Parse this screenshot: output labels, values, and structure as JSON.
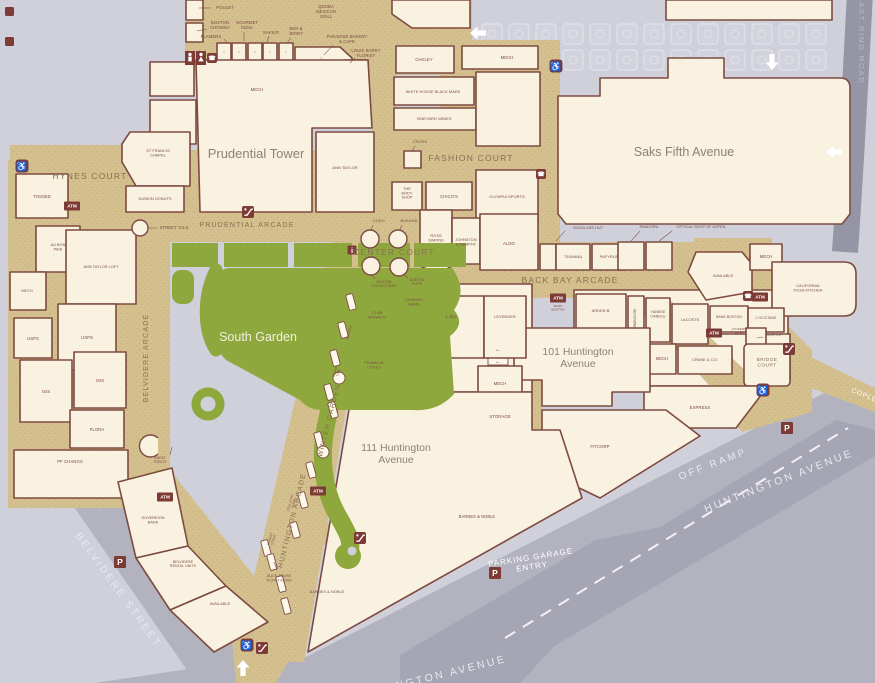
{
  "title": "Prudential Center mall directory map",
  "colors": {
    "walkway": "#d4c08f",
    "speckle": "#c6ae74",
    "block": "#f9f2e1",
    "outline": "#7e4a40",
    "garden": "#8ea83e",
    "street": "#b3b3c0",
    "ramp": "#a5a5b3",
    "badge": "#7e3b36",
    "label": "#7b4a42"
  },
  "labels": [
    {
      "id": "poulet",
      "t": "POULET",
      "x": 225,
      "y": 9,
      "ld": [
        211,
        8,
        199,
        8
      ]
    },
    {
      "id": "boston-chowda",
      "t": "BOSTON|CHOWDA",
      "x": 220,
      "y": 24,
      "ld": [
        207,
        29,
        197,
        31
      ]
    },
    {
      "id": "flamers",
      "t": "FLAMERS",
      "x": 211,
      "y": 38,
      "ld": [
        224,
        39,
        228,
        44
      ]
    },
    {
      "id": "gourmet-india",
      "t": "GOURMET|INDIA",
      "x": 247,
      "y": 24,
      "ld": [
        244,
        32,
        244,
        41
      ]
    },
    {
      "id": "sakkio",
      "t": "SAKKIO",
      "x": 271,
      "y": 34,
      "ld": [
        269,
        36,
        267,
        42
      ]
    },
    {
      "id": "ben-jerry",
      "t": "BEN &|JERRY",
      "x": 296,
      "y": 30,
      "ld": [
        291,
        38,
        287,
        43
      ]
    },
    {
      "id": "qdoba",
      "t": "QDOBA|MEXICAN|GRILL",
      "x": 326,
      "y": 8
    },
    {
      "id": "paradise-bakery",
      "t": "PARADISE BAKERY|& CAFE",
      "x": 347,
      "y": 38,
      "ld": [
        333,
        45,
        324,
        55
      ]
    },
    {
      "id": "louie-barry",
      "t": "LOUIE BARRY|FLORIST",
      "x": 366,
      "y": 52,
      "ld": [
        355,
        58,
        350,
        63
      ]
    },
    {
      "id": "mech-top",
      "t": "MECH",
      "x": 257,
      "y": 91
    },
    {
      "id": "oakley",
      "t": "OAKLEY",
      "x": 424,
      "y": 61
    },
    {
      "id": "white-house-black-market",
      "t": "WHITE HOUSE BLACK MARK",
      "x": 433,
      "y": 93,
      "s": 3.9
    },
    {
      "id": "vineyard-vines",
      "t": "VINEYARD WINES",
      "x": 434,
      "y": 120,
      "s": 4
    },
    {
      "id": "mech-tr",
      "t": "MECH",
      "x": 507,
      "y": 59
    },
    {
      "id": "st-francis-chapel",
      "t": "ST FRANCIS|CHAPEL",
      "x": 158,
      "y": 152,
      "s": 3.9
    },
    {
      "id": "dunkin-donuts",
      "t": "DUNKIN DONUTS",
      "x": 155,
      "y": 200,
      "s": 3.9
    },
    {
      "id": "street-talk",
      "t": "STREET TALK",
      "x": 174,
      "y": 229,
      "ld": [
        157,
        228,
        149,
        228
      ]
    },
    {
      "id": "ann-taylor",
      "t": "ANN TAYLOR",
      "x": 345,
      "y": 169,
      "s": 4
    },
    {
      "id": "cross",
      "t": "CROSS",
      "x": 420,
      "y": 143,
      "s": 3.9,
      "ld": [
        415,
        146,
        412,
        151
      ]
    },
    {
      "id": "the-body-shop",
      "t": "THE|BODY|SHOP",
      "x": 407,
      "y": 190,
      "s": 3.8
    },
    {
      "id": "chicos",
      "t": "CHICO'S",
      "x": 449,
      "y": 198
    },
    {
      "id": "olympia-sports",
      "t": "OLYMPIA SPORTS",
      "x": 507,
      "y": 198,
      "s": 4
    },
    {
      "id": "koko",
      "t": "KOKO",
      "x": 379,
      "y": 222,
      "s": 3.9,
      "ld": [
        373,
        225,
        371,
        230
      ]
    },
    {
      "id": "busuma",
      "t": "BUSUMA",
      "x": 409,
      "y": 222,
      "s": 3.9,
      "ld": [
        402,
        225,
        400,
        230
      ]
    },
    {
      "id": "boston-collections",
      "t": "BOSTON|COLLECTIONS",
      "x": 384,
      "y": 283,
      "s": 3.5,
      "ld": [
        375,
        279,
        372,
        275
      ]
    },
    {
      "id": "boston-pops",
      "t": "BOSTON|POPS",
      "x": 417,
      "y": 281,
      "s": 3.5,
      "ld": [
        408,
        278,
        403,
        274
      ]
    },
    {
      "id": "ross-simons",
      "t": "ROSS|SIMONS",
      "x": 436,
      "y": 237,
      "s": 3.9
    },
    {
      "id": "johnston-murphy",
      "t": "JOHNSTON|& MURPHY",
      "x": 466,
      "y": 241,
      "s": 3.8
    },
    {
      "id": "aldo",
      "t": "ALDO",
      "x": 509,
      "y": 245
    },
    {
      "id": "sunglass-hut",
      "t": "SUNGLASS HUT",
      "x": 588,
      "y": 229,
      "s": 3.8,
      "ld": [
        565,
        231,
        556,
        241
      ]
    },
    {
      "id": "pandora",
      "t": "PANDORA",
      "x": 649,
      "y": 228,
      "s": 3.8,
      "ld": [
        640,
        231,
        631,
        241
      ]
    },
    {
      "id": "optical-shop-of-aspen",
      "t": "OPTICAL SHOP OF ASPEN",
      "x": 701,
      "y": 228,
      "s": 3.8,
      "ld": [
        672,
        231,
        659,
        241
      ]
    },
    {
      "id": "teavana",
      "t": "TEAVANA",
      "x": 573,
      "y": 258,
      "s": 3.9
    },
    {
      "id": "papyrus",
      "t": "PAPYRUS",
      "x": 609,
      "y": 258,
      "s": 3.9
    },
    {
      "id": "available-right",
      "t": "AVAILABLE",
      "x": 723,
      "y": 277,
      "s": 3.8
    },
    {
      "id": "mech-right",
      "t": "MECH",
      "x": 766,
      "y": 258
    },
    {
      "id": "california-pizza-kitchen",
      "t": "CALIFORNIA|PIZZA KITCHEN",
      "x": 808,
      "y": 287,
      "s": 3.8
    },
    {
      "id": "bank-boston-atm",
      "t": "BANK|BOSTON",
      "x": 558,
      "y": 307,
      "s": 3.1
    },
    {
      "id": "arden-b",
      "t": "ARDEN B.",
      "x": 601,
      "y": 312,
      "s": 3.9
    },
    {
      "id": "swarovski",
      "t": "SWAROVSKI",
      "x": 636,
      "y": 319,
      "r": -90,
      "s": 3.3
    },
    {
      "id": "yankee-candle",
      "t": "YANKEE|CANDLE",
      "x": 658,
      "y": 313,
      "s": 3.7
    },
    {
      "id": "lacoste",
      "t": "LACOSTE",
      "x": 690,
      "y": 321,
      "s": 3.9
    },
    {
      "id": "bank-boston",
      "t": "BANK BOSTON",
      "x": 729,
      "y": 318,
      "s": 3.5
    },
    {
      "id": "loccitane",
      "t": "L'OCCITANE",
      "x": 766,
      "y": 319,
      "s": 3.5
    },
    {
      "id": "citizens-bank",
      "t": "CITIZENS|BANK",
      "x": 739,
      "y": 330,
      "s": 3.1
    },
    {
      "id": "clutch",
      "t": "CLUTCH",
      "x": 774,
      "y": 336,
      "s": 3.5,
      "ld": [
        763,
        337,
        757,
        338
      ]
    },
    {
      "id": "crane-co",
      "t": "CRANE & CO.",
      "x": 705,
      "y": 361,
      "s": 3.9
    },
    {
      "id": "mech-center",
      "t": "MECH",
      "x": 662,
      "y": 360
    },
    {
      "id": "express",
      "t": "EXPRESS",
      "x": 700,
      "y": 409
    },
    {
      "id": "fitcorp",
      "t": "FITCORP",
      "x": 600,
      "y": 448
    },
    {
      "id": "mech-101",
      "t": "MECH",
      "x": 500,
      "y": 385
    },
    {
      "id": "storage",
      "t": "STORAGE",
      "x": 500,
      "y": 418
    },
    {
      "id": "club-monaco",
      "t": "CLUB|MONACO",
      "x": 377,
      "y": 314,
      "s": 3.9
    },
    {
      "id": "charles-david",
      "t": "CHARLES|DAVID",
      "x": 414,
      "y": 301,
      "s": 3.8
    },
    {
      "id": "jjill",
      "t": "J.JILL",
      "x": 451,
      "y": 318
    },
    {
      "id": "levenger",
      "t": "LEVENGER",
      "x": 505,
      "y": 318,
      "s": 3.9
    },
    {
      "id": "franklin-covey",
      "t": "FRANKLIN|COVEY",
      "x": 374,
      "y": 364,
      "s": 3.8
    },
    {
      "id": "verizon",
      "t": "VERIZON",
      "x": 350,
      "y": 333,
      "r": -74,
      "s": 3.2
    },
    {
      "id": "ocean-time",
      "t": "OCEAN|TIME",
      "x": 336,
      "y": 372,
      "r": -74,
      "s": 3.1
    },
    {
      "id": "cellular-flair",
      "t": "CELLULAR|FLAIR",
      "x": 291,
      "y": 503,
      "r": -74,
      "s": 3.1
    },
    {
      "id": "robert-stone",
      "t": "ROBERT|STONE",
      "x": 271,
      "y": 539,
      "r": -74,
      "s": 3.1
    },
    {
      "id": "duck-tours",
      "t": "DUCK TOURS|TICKET KIOSK",
      "x": 279,
      "y": 577,
      "s": 3.7,
      "ld": [
        277,
        570,
        274,
        562
      ]
    },
    {
      "id": "barnes-noble-1",
      "t": "BARNES & NOBLE",
      "x": 477,
      "y": 518,
      "s": 4.1
    },
    {
      "id": "barnes-noble-2",
      "t": "BARNES & NOBLE",
      "x": 327,
      "y": 593,
      "s": 3.9
    },
    {
      "id": "sweet-treats",
      "t": "SWEET|TREATS",
      "x": 160,
      "y": 459,
      "s": 3.3,
      "ld": [
        170,
        455,
        172,
        447
      ]
    },
    {
      "id": "sovereign-bank",
      "t": "SOVEREIGN|BANK",
      "x": 153,
      "y": 519,
      "s": 3.8
    },
    {
      "id": "belvidere-rental-units",
      "t": "BELVIDERE|RENTAL UNITS",
      "x": 183,
      "y": 563,
      "s": 3.6
    },
    {
      "id": "available-bottom",
      "t": "AVAILABLE",
      "x": 220,
      "y": 605,
      "s": 3.8
    },
    {
      "id": "tossed",
      "t": "TOSSED",
      "x": 42,
      "y": 198
    },
    {
      "id": "au-bon-pain",
      "t": "AU BON|PAIN",
      "x": 58,
      "y": 246,
      "s": 3.8
    },
    {
      "id": "ann-taylor-loft",
      "t": "ANN TAYLOR LOFT",
      "x": 101,
      "y": 268,
      "s": 3.8
    },
    {
      "id": "mech-left",
      "t": "MECH",
      "x": 27,
      "y": 292,
      "s": 3.8
    },
    {
      "id": "usps-1",
      "t": "USPS",
      "x": 33,
      "y": 340
    },
    {
      "id": "usps-2",
      "t": "USPS",
      "x": 87,
      "y": 339
    },
    {
      "id": "isis-1",
      "t": "ISIS",
      "x": 46,
      "y": 393
    },
    {
      "id": "isis-2",
      "t": "ISIS",
      "x": 100,
      "y": 382
    },
    {
      "id": "flora",
      "t": "FLORA",
      "x": 97,
      "y": 431
    },
    {
      "id": "pf-changs",
      "t": "PF CHANGS",
      "x": 70,
      "y": 463
    },
    {
      "id": "esc-arrow-1",
      "t": "←",
      "x": 498,
      "y": 351,
      "s": 6,
      "cls": "maroon"
    },
    {
      "id": "esc-arrow-2",
      "t": "←",
      "x": 498,
      "y": 363,
      "s": 6,
      "cls": "maroon"
    },
    {
      "id": "stall-arrow-1",
      "t": "↓",
      "x": 224,
      "y": 53,
      "s": 4.5,
      "cls": "maroon"
    },
    {
      "id": "stall-arrow-2",
      "t": "↓",
      "x": 239,
      "y": 53,
      "s": 4.5,
      "cls": "maroon"
    },
    {
      "id": "stall-arrow-3",
      "t": "↓",
      "x": 255,
      "y": 53,
      "s": 4.5,
      "cls": "maroon"
    },
    {
      "id": "stall-arrow-4",
      "t": "↓",
      "x": 270,
      "y": 53,
      "s": 4.5,
      "cls": "maroon"
    },
    {
      "id": "stall-arrow-5",
      "t": "↓",
      "x": 286,
      "y": 53,
      "s": 4.5,
      "cls": "maroon"
    },
    {
      "id": "stall-arrow-6",
      "t": "↓",
      "x": 321,
      "y": 59,
      "s": 4.5,
      "cls": "maroon"
    },
    {
      "id": "hynes-court",
      "t": "HYNES COURT",
      "x": 90,
      "y": 179,
      "s": 8.5,
      "cls": "area"
    },
    {
      "id": "prudential-arcade",
      "t": "PRUDENTIAL ARCADE",
      "x": 247,
      "y": 227,
      "s": 7,
      "cls": "area"
    },
    {
      "id": "center-court",
      "t": "CENTER COURT",
      "x": 394,
      "y": 255,
      "s": 8.5,
      "cls": "area"
    },
    {
      "id": "fashion-court",
      "t": "FASHION COURT",
      "x": 471,
      "y": 161,
      "s": 8.5,
      "cls": "area"
    },
    {
      "id": "back-bay-arcade",
      "t": "BACK BAY ARCADE",
      "x": 570,
      "y": 283,
      "s": 8.5,
      "cls": "area"
    },
    {
      "id": "belvidere-arcade",
      "t": "BELVIDERE ARCADE",
      "x": 148,
      "y": 358,
      "r": -90,
      "s": 7,
      "cls": "area"
    },
    {
      "id": "winter-garden",
      "t": "WINTER GARDEN",
      "x": 331,
      "y": 421,
      "r": -76,
      "s": 7,
      "cls": "area"
    },
    {
      "id": "huntington-arcade",
      "t": "HUNTINGTON ARCADE",
      "x": 294,
      "y": 521,
      "r": -76,
      "s": 7,
      "cls": "area"
    },
    {
      "id": "bridge-court",
      "t": "BRIDGE|COURT",
      "x": 767,
      "y": 361,
      "s": 4.8,
      "cls": "area2"
    },
    {
      "id": "prudential-tower",
      "t": "Prudential Tower",
      "x": 256,
      "y": 158,
      "s": 13,
      "cls": "big"
    },
    {
      "id": "saks-fifth-avenue",
      "t": "Saks Fifth Avenue",
      "x": 684,
      "y": 156,
      "s": 12.5,
      "cls": "big"
    },
    {
      "id": "101-huntington-avenue",
      "t": "101 Huntington|Avenue",
      "x": 578,
      "y": 355,
      "s": 10.5,
      "cls": "big"
    },
    {
      "id": "111-huntington-avenue",
      "t": "111 Huntington|Avenue",
      "x": 396,
      "y": 451,
      "s": 10.5,
      "cls": "big"
    },
    {
      "id": "south-garden",
      "t": "South Garden",
      "x": 258,
      "y": 341,
      "s": 12.5,
      "cls": "garden"
    },
    {
      "id": "belvidere-street",
      "t": "BELVIDERE STREET",
      "x": 116,
      "y": 592,
      "r": 54,
      "s": 10,
      "cls": "street"
    },
    {
      "id": "huntington-avenue",
      "t": "HUNTINGTON AVENUE",
      "x": 780,
      "y": 484,
      "r": -21,
      "s": 10.5,
      "cls": "street"
    },
    {
      "id": "off-ramp",
      "t": "OFF RAMP",
      "x": 714,
      "y": 467,
      "r": -21,
      "s": 10,
      "cls": "street"
    },
    {
      "id": "parking-garage-entry",
      "t": "PARKING GARAGE|ENTRY",
      "x": 531,
      "y": 560,
      "r": -9,
      "s": 8,
      "cls": "street2"
    },
    {
      "id": "east-ring-road",
      "t": "EAST RING ROAD",
      "x": 859,
      "y": 40,
      "r": 90,
      "s": 7.5,
      "cls": "street3"
    },
    {
      "id": "copley",
      "t": "COPLEY",
      "x": 866,
      "y": 398,
      "r": 22,
      "s": 6.5,
      "cls": "street2"
    },
    {
      "id": "huntington-avenue-2",
      "t": "HUNTINGTON AVENUE",
      "x": 430,
      "y": 681,
      "r": -14,
      "s": 10.5,
      "cls": "street"
    }
  ],
  "icons": [
    {
      "id": "restroom-men-icon",
      "type": "wc-men",
      "x": 190,
      "y": 58
    },
    {
      "id": "restroom-women-icon",
      "type": "wc-women",
      "x": 201,
      "y": 58
    },
    {
      "id": "phone-icon-1",
      "type": "phone",
      "x": 212,
      "y": 58
    },
    {
      "id": "phone-icon-2",
      "type": "phone",
      "x": 541,
      "y": 174
    },
    {
      "id": "phone-icon-3",
      "type": "phone",
      "x": 748,
      "y": 296
    },
    {
      "id": "handicap-icon-1",
      "type": "handicap",
      "x": 22,
      "y": 166
    },
    {
      "id": "handicap-icon-2",
      "type": "handicap",
      "x": 556,
      "y": 66
    },
    {
      "id": "handicap-icon-3",
      "type": "handicap",
      "x": 763,
      "y": 390
    },
    {
      "id": "handicap-icon-4",
      "type": "handicap",
      "x": 247,
      "y": 645
    },
    {
      "id": "atm-icon-1",
      "type": "atm",
      "x": 72,
      "y": 206
    },
    {
      "id": "atm-icon-2",
      "type": "atm",
      "x": 165,
      "y": 497
    },
    {
      "id": "atm-icon-3",
      "type": "atm",
      "x": 318,
      "y": 491
    },
    {
      "id": "atm-icon-4",
      "type": "atm",
      "x": 558,
      "y": 298
    },
    {
      "id": "atm-icon-5",
      "type": "atm",
      "x": 714,
      "y": 333
    },
    {
      "id": "atm-icon-6",
      "type": "atm",
      "x": 760,
      "y": 297
    },
    {
      "id": "info-icon",
      "type": "info",
      "x": 352,
      "y": 250
    },
    {
      "id": "escalator-icon-1",
      "type": "esc",
      "x": 248,
      "y": 212
    },
    {
      "id": "escalator-icon-2",
      "type": "esc",
      "x": 360,
      "y": 538
    },
    {
      "id": "escalator-icon-3",
      "type": "esc",
      "x": 789,
      "y": 349
    },
    {
      "id": "escalator-icon-4",
      "type": "esc",
      "x": 262,
      "y": 648
    },
    {
      "id": "parking-icon-1",
      "type": "p",
      "x": 120,
      "y": 562
    },
    {
      "id": "parking-icon-2",
      "type": "p",
      "x": 495,
      "y": 573
    },
    {
      "id": "parking-icon-3",
      "type": "p",
      "x": 787,
      "y": 428
    },
    {
      "id": "entrance-arrow-down",
      "type": "arrow",
      "x": 772,
      "y": 62,
      "r": 180
    },
    {
      "id": "entrance-arrow-left-1",
      "type": "arrow",
      "x": 478,
      "y": 33,
      "r": -90
    },
    {
      "id": "entrance-arrow-left-2",
      "type": "arrow",
      "x": 834,
      "y": 152,
      "r": -90
    },
    {
      "id": "entrance-arrow-up",
      "type": "arrow",
      "x": 243,
      "y": 668,
      "r": 0
    }
  ],
  "kiosks": [
    {
      "id": "kiosk-koko",
      "x": 370,
      "y": 239,
      "rad": 9
    },
    {
      "id": "kiosk-busuma",
      "x": 398,
      "y": 239,
      "rad": 9
    },
    {
      "id": "kiosk-boston-collections",
      "x": 371,
      "y": 266,
      "rad": 9
    },
    {
      "id": "kiosk-boston-pops",
      "x": 399,
      "y": 267,
      "rad": 9
    },
    {
      "id": "kiosk-street-talk",
      "x": 140,
      "y": 228,
      "rad": 8
    }
  ],
  "benches": [
    [
      351,
      302
    ],
    [
      343,
      330
    ],
    [
      335,
      358
    ],
    [
      329,
      392
    ],
    [
      333,
      410
    ],
    [
      319,
      440
    ],
    [
      311,
      470
    ],
    [
      303,
      500
    ],
    [
      295,
      530
    ],
    [
      281,
      584
    ],
    [
      286,
      606
    ],
    [
      266,
      548
    ],
    [
      272,
      562
    ]
  ],
  "bench_circles": [
    [
      339,
      378
    ],
    [
      323,
      452
    ]
  ]
}
